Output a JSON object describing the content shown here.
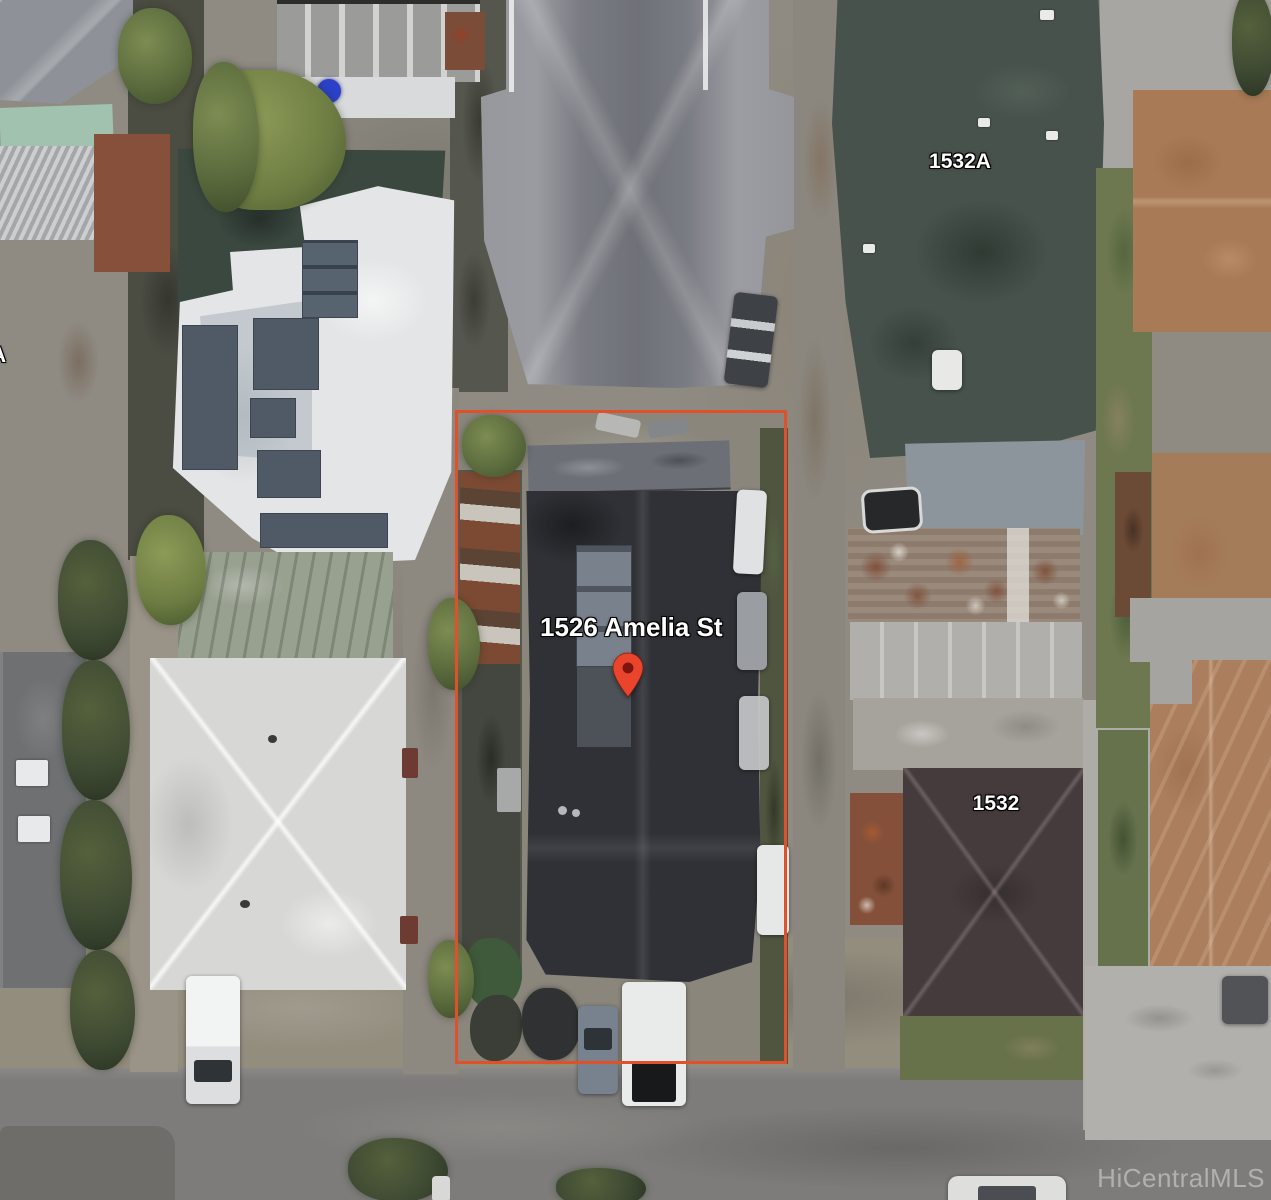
{
  "image": {
    "type": "aerial-satellite-photo",
    "description": "Overhead satellite view of a residential block with the subject lot outlined in orange"
  },
  "labels": {
    "subject_address": "1526 Amelia St",
    "neighbor_top_right": "1532A",
    "neighbor_right": "1532",
    "neighbor_left_partial": "3A",
    "watermark": "HiCentralMLS"
  },
  "colors": {
    "boundary_color": "#e0502a",
    "pin_color": "#e8452c",
    "pin_center_color": "#7e150c",
    "address_text_color": "#ffffff",
    "watermark_color": "#dcdcdc"
  }
}
